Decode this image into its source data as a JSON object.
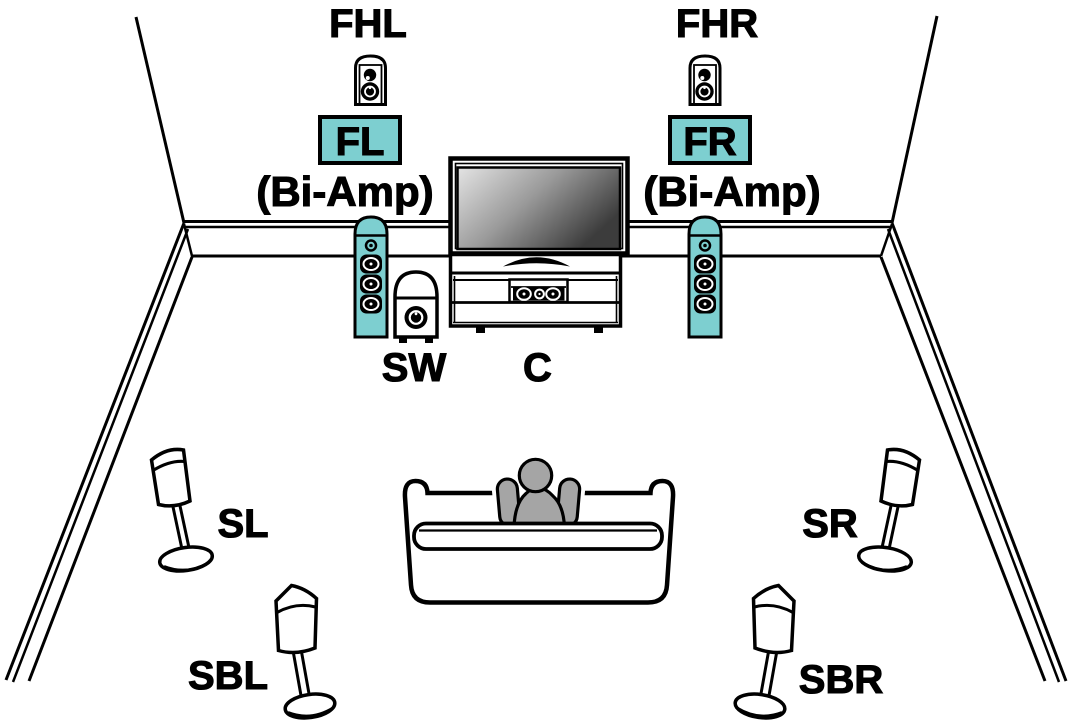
{
  "diagram": {
    "type": "speaker-placement-diagram",
    "labels": {
      "fhl": "FHL",
      "fhr": "FHR",
      "fl": "FL",
      "fr": "FR",
      "bi_amp_left": "(Bi-Amp)",
      "bi_amp_right": "(Bi-Amp)",
      "sw": "SW",
      "c": "C",
      "sl": "SL",
      "sr": "SR",
      "sbl": "SBL",
      "sbr": "SBR"
    },
    "colors": {
      "highlight_teal": "#7DCFD0",
      "person_gray": "#A5A5A5",
      "line_black": "#000000",
      "background_white": "#FFFFFF"
    }
  }
}
